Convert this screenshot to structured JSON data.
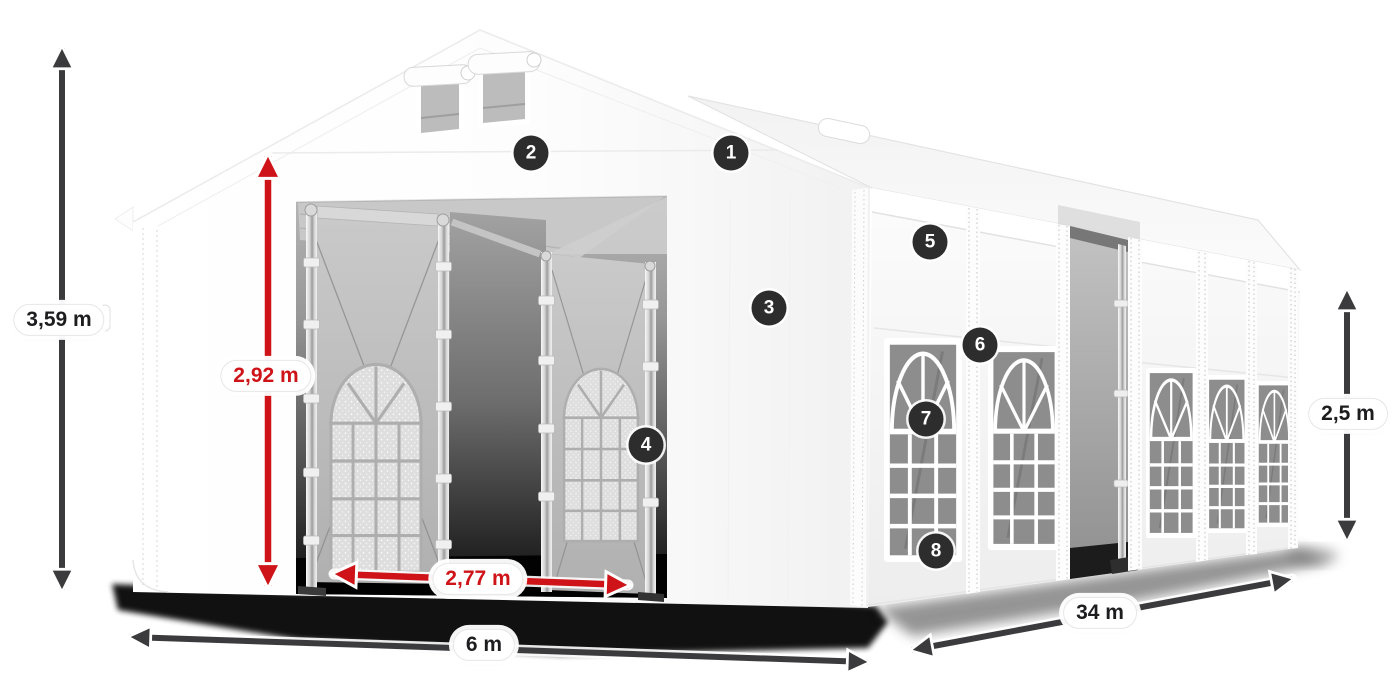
{
  "figure": {
    "type": "product-dimension-diagram",
    "subject": "White PVC marquee tent 6 x 34 m with numbered feature callouts"
  },
  "dimensions": {
    "total_height": {
      "label": "3,59 m",
      "color": "dark",
      "orientation": "vertical"
    },
    "entrance_height": {
      "label": "2,92 m",
      "color": "red",
      "orientation": "vertical"
    },
    "entrance_width": {
      "label": "2,77 m",
      "color": "red",
      "orientation": "horizontal"
    },
    "width": {
      "label": "6 m",
      "color": "dark",
      "orientation": "horizontal"
    },
    "length": {
      "label": "34 m",
      "color": "dark",
      "orientation": "diagonal"
    },
    "side_height": {
      "label": "2,5 m",
      "color": "dark",
      "orientation": "vertical"
    }
  },
  "markers": [
    {
      "number": "1"
    },
    {
      "number": "2"
    },
    {
      "number": "3"
    },
    {
      "number": "4"
    },
    {
      "number": "5"
    },
    {
      "number": "6"
    },
    {
      "number": "7"
    },
    {
      "number": "8"
    }
  ],
  "colors": {
    "accent_red": "#ce1418",
    "arrow_dark": "#3b3b3d",
    "marker_bg": "#2d2d2e",
    "marker_text": "#ffffff",
    "background": "#ffffff"
  }
}
